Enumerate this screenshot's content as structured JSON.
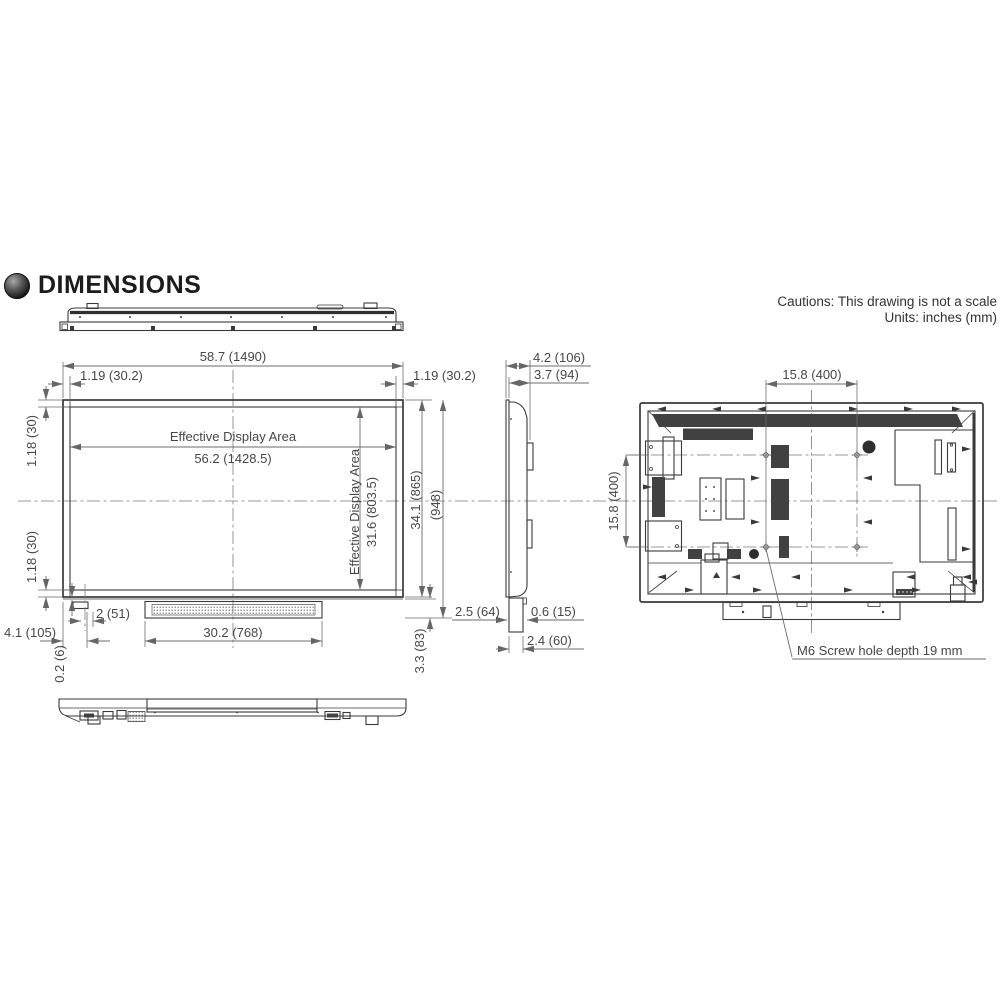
{
  "header": {
    "title": "DIMENSIONS",
    "bullet_icon": "dark-sphere",
    "caution_line1": "Cautions: This drawing is not a scale",
    "caution_line2": "Units: inches (mm)"
  },
  "front": {
    "overall_width": "58.7 (1490)",
    "bezel_side_left": "1.19 (30.2)",
    "bezel_side_right": "1.19 (30.2)",
    "bezel_top": "1.18 (30)",
    "bezel_bottom": "1.18 (30)",
    "eda_title_h": "Effective Display Area",
    "eda_width": "56.2 (1428.5)",
    "eda_title_v": "Effective Display Area",
    "eda_height": "31.6 (803.5)",
    "height_panel": "34.1 (865)",
    "height_total": "(948)",
    "bottom_strip_height": "3.3 (83)",
    "bottom_box_width": "4.1 (105)",
    "bottom_box_height": "0.2 (6)",
    "sensor_offset": "2 (51)",
    "speaker_width": "30.2 (768)"
  },
  "side": {
    "depth_total": "4.2 (106)",
    "depth_body": "3.7 (94)",
    "front_gap": "2.5 (64)",
    "stand_step": "0.6 (15)",
    "stand_depth": "2.4 (60)"
  },
  "rear": {
    "vesa_width": "15.8 (400)",
    "vesa_height": "15.8 (400)",
    "screw_note": "M6 Screw hole depth 19 mm"
  },
  "colors": {
    "line": "#3a3a3a",
    "dim_line": "#6b6b6b",
    "dark_fill": "#414141"
  }
}
